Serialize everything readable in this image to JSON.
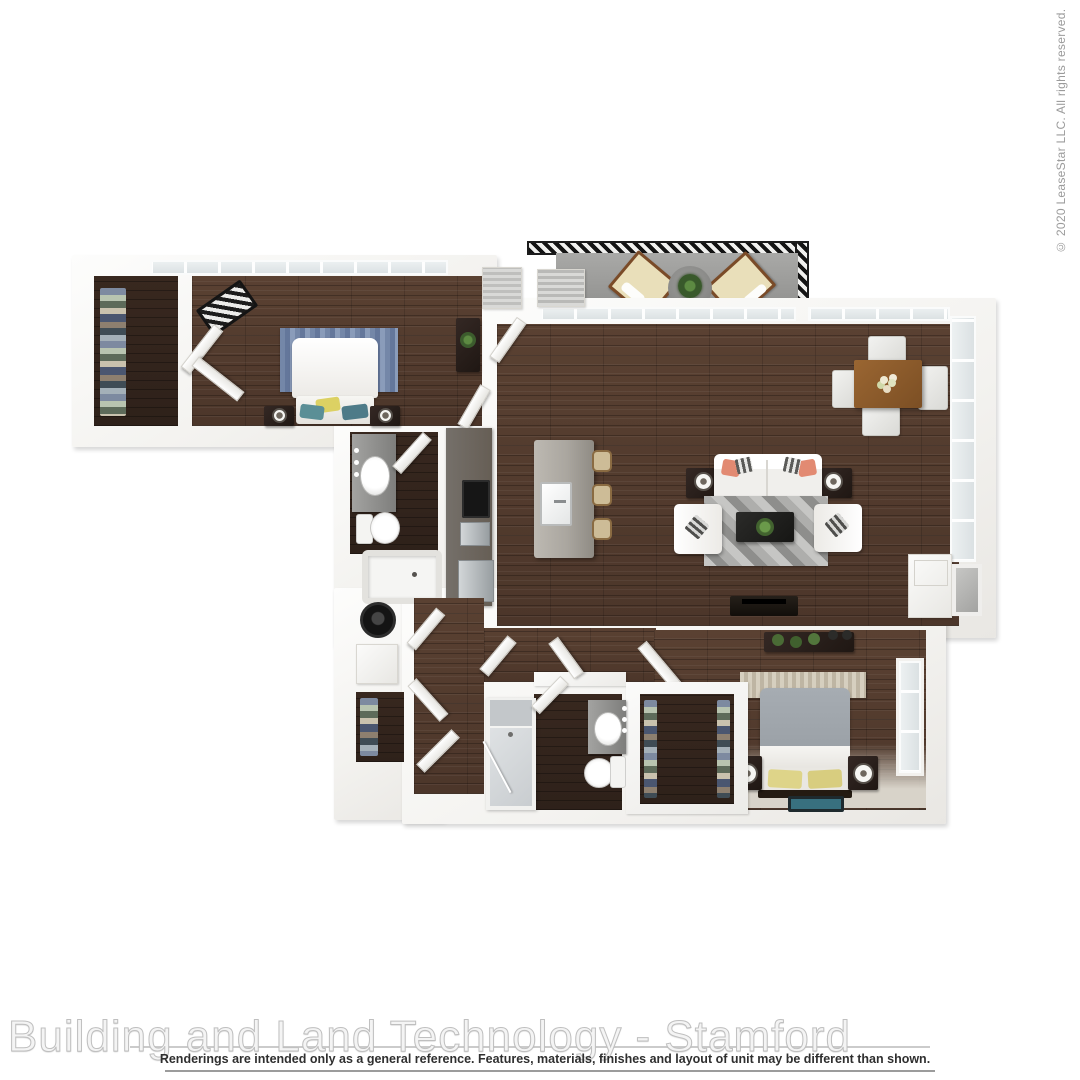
{
  "texts": {
    "copyright": "© 2020 LeaseStar LLC. All rights reserved.",
    "watermark": "Building and Land Technology - Stamford",
    "disclaimer": "Renderings are intended only as a general reference. Features, materials, finishes and layout of unit may be different than shown."
  },
  "colors": {
    "wood": "#4c362a",
    "woodLight": "#5a4132",
    "woodDark": "#38281f",
    "wall": "#f6f5f2",
    "balcony": "#9b9b99",
    "rugBlue": "#7487a8",
    "rugGray": "#9c9c9a",
    "accentCoral": "#e28a72",
    "accentYellow": "#dcd163",
    "accentTeal": "#38707f",
    "bed2Gray": "#9ba1a7",
    "counter": "#665e55",
    "island": "#aaa69f",
    "steel": "#b9bdbf"
  },
  "floorplan": {
    "type": "apartment-floor-plan-3d-top-view",
    "rooms": [
      "bedroom-1",
      "walk-in-closet-1",
      "bathroom-1",
      "kitchen",
      "living-room",
      "dining-area",
      "balcony",
      "laundry-closet",
      "hallway",
      "bathroom-2",
      "walk-in-closet-2",
      "bedroom-2"
    ]
  }
}
